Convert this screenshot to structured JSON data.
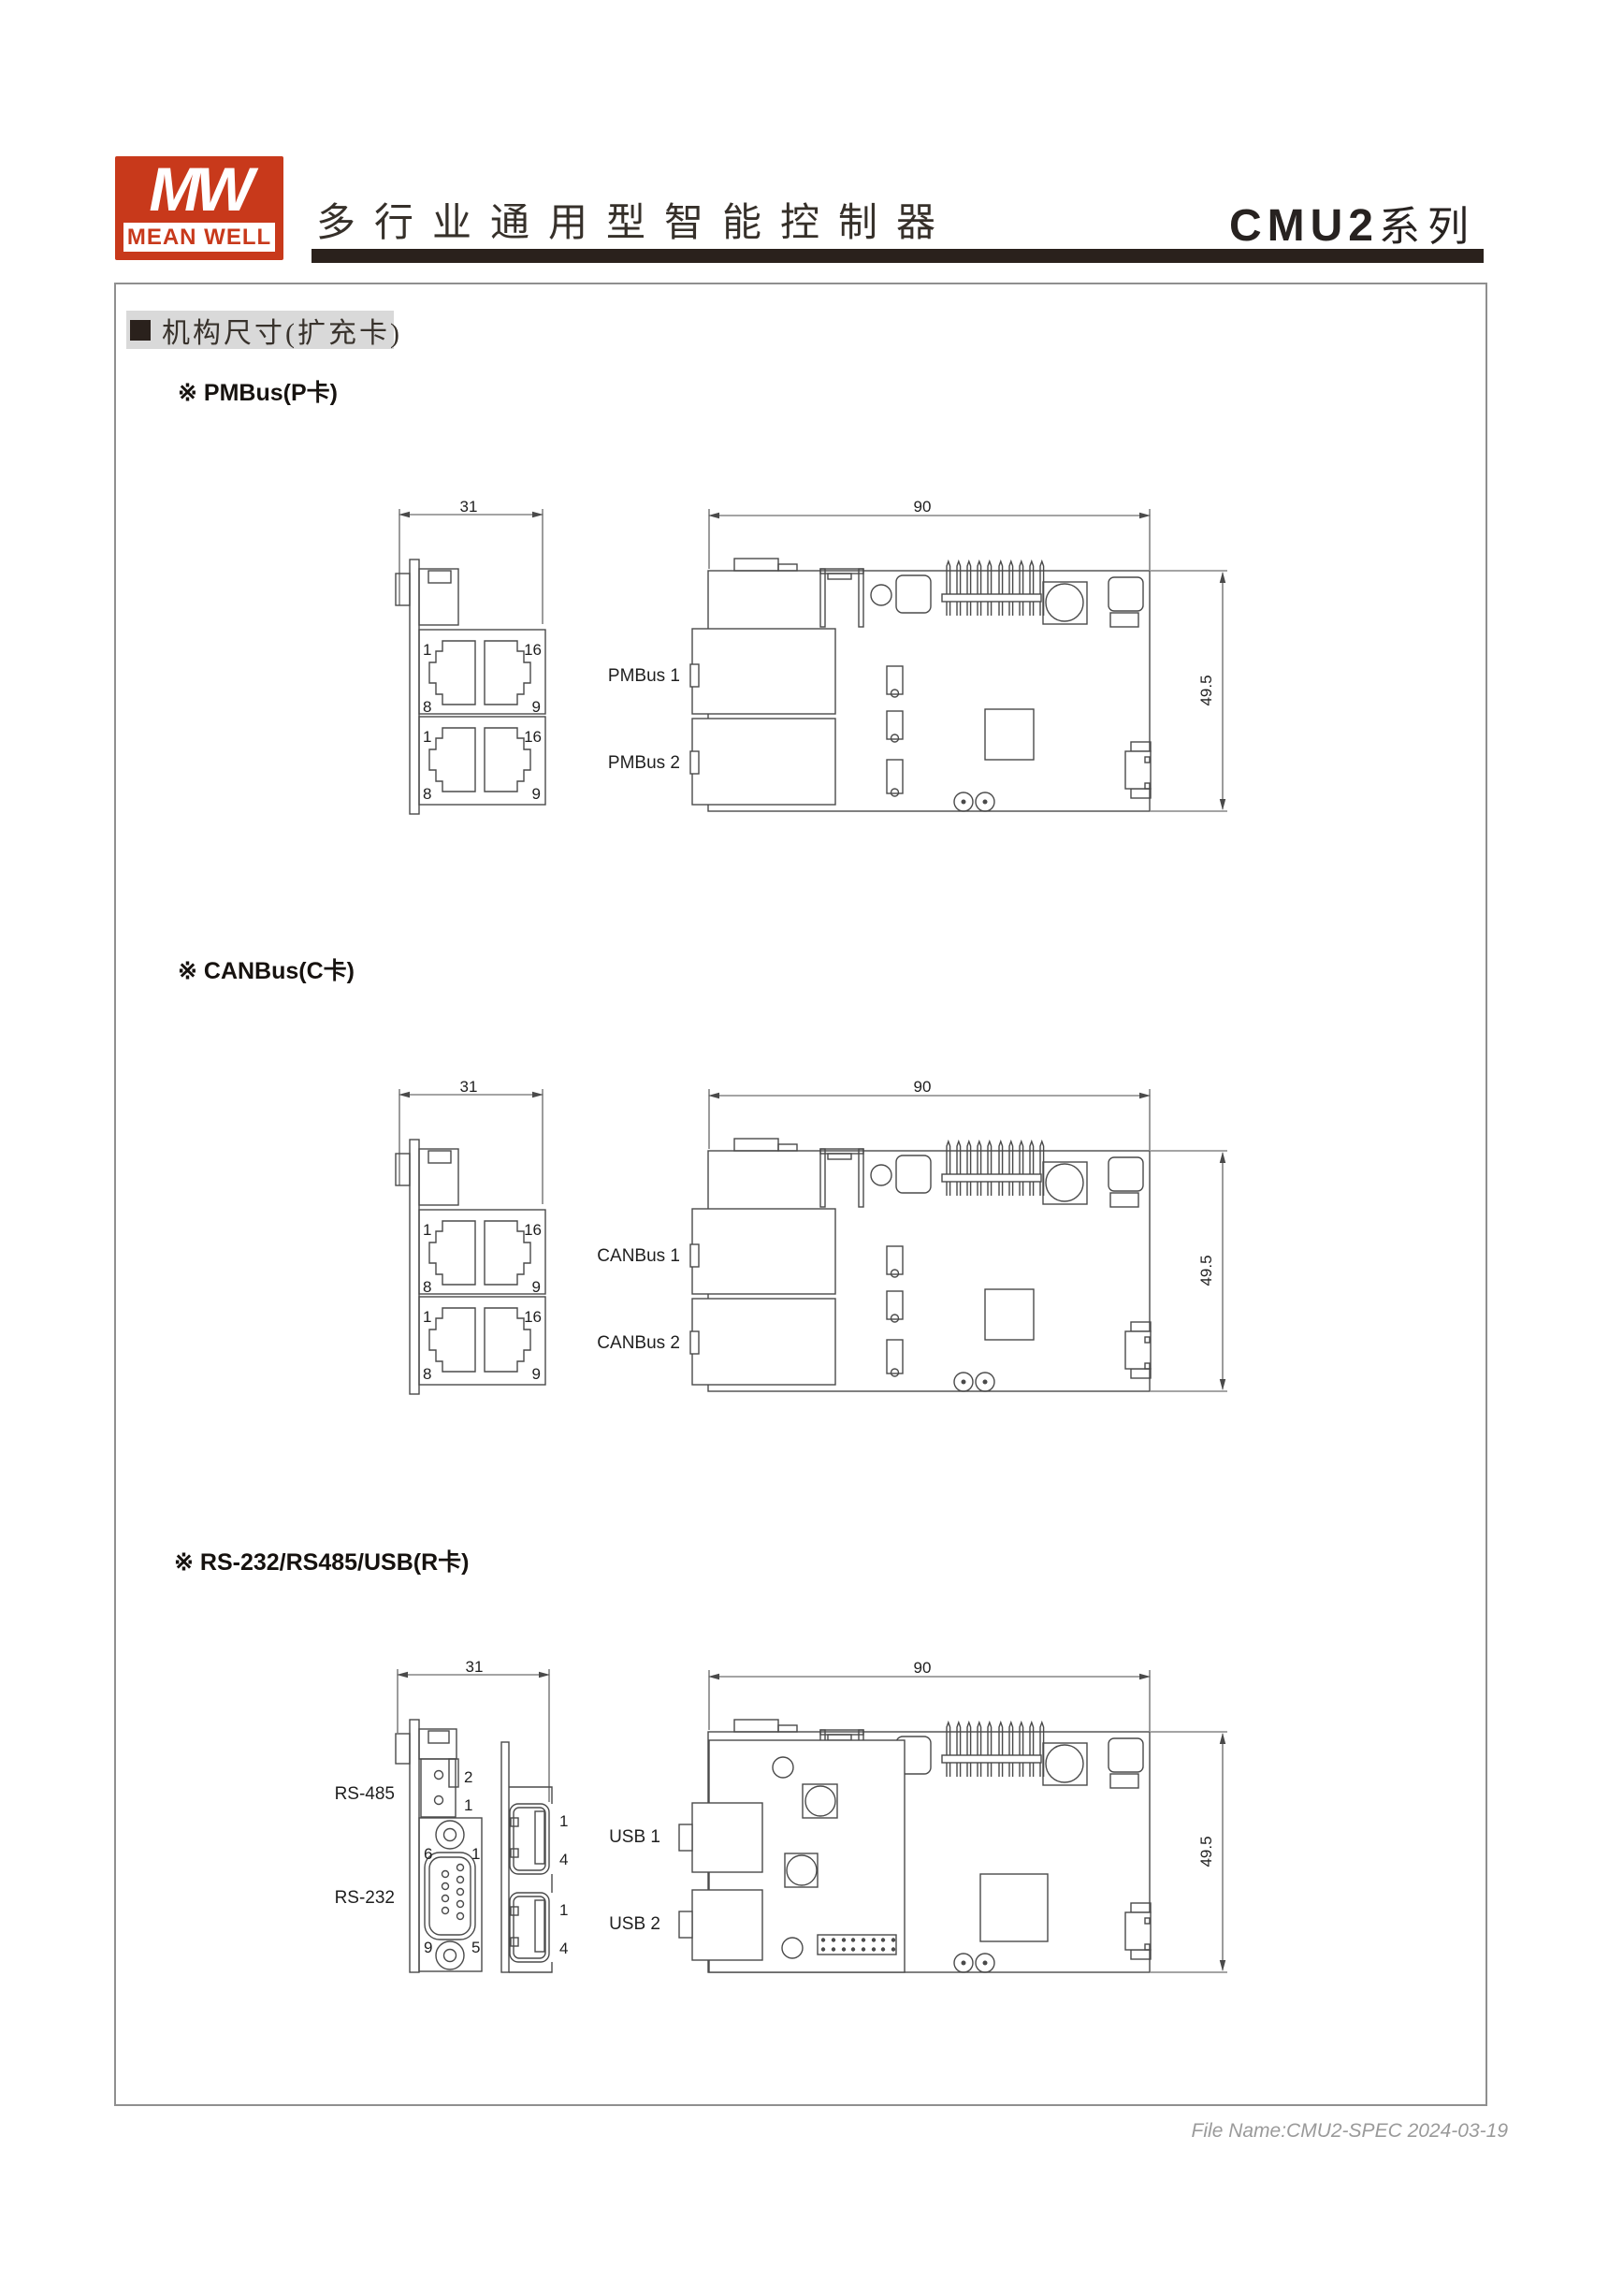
{
  "header": {
    "logo_mw": "MW",
    "logo_name": "MEAN WELL",
    "title": "多行业通用型智能控制器",
    "series_model": "CMU2",
    "series_suffix": "系列"
  },
  "content": {
    "section_title": "机构尺寸(扩充卡)",
    "sections": [
      {
        "heading": "※ PMBus(P卡)",
        "port1": "PMBus 1",
        "port2": "PMBus 2"
      },
      {
        "heading": "※ CANBus(C卡)",
        "port1": "CANBus 1",
        "port2": "CANBus 2"
      },
      {
        "heading": "※ RS-232/RS485/USB(R卡)",
        "port1": "USB 1",
        "port2": "USB 2"
      }
    ]
  },
  "drawing": {
    "dim_width": "31",
    "dim_length": "90",
    "dim_height": "49.5",
    "pins": {
      "p1": "1",
      "p16": "16",
      "p8": "8",
      "p9": "9"
    },
    "r_card": {
      "rs485": "RS-485",
      "rs232": "RS-232",
      "term_pin_top": "2",
      "term_pin_bottom": "1",
      "db9_tl": "6",
      "db9_tr": "1",
      "db9_bl": "9",
      "db9_br": "5",
      "usb_pin_top": "1",
      "usb_pin_bottom": "4"
    }
  },
  "footer": {
    "file_name": "File Name:CMU2-SPEC  2024-03-19"
  }
}
